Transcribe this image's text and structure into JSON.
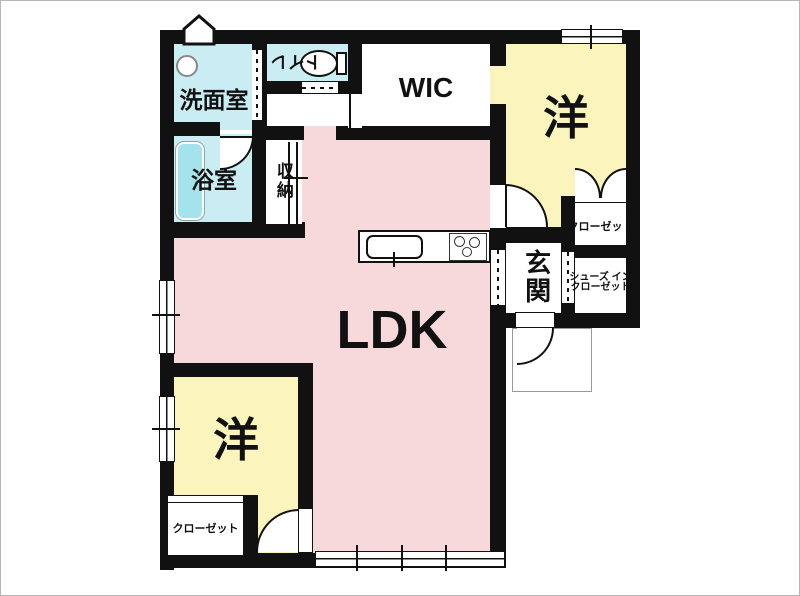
{
  "colors": {
    "wall": "#111111",
    "water_room": "#c9edf3",
    "bedroom": "#fbf5bd",
    "ldk": "#f8d9db",
    "bathtub": "#a5e3ec"
  },
  "rooms": {
    "washroom": {
      "label": "洗面室"
    },
    "toilet": {
      "label": "トイレ"
    },
    "bathroom": {
      "label": "浴室"
    },
    "storage": {
      "label": "収納"
    },
    "wic": {
      "label": "WIC"
    },
    "bedroom_top": {
      "label": "洋"
    },
    "closet_top": {
      "label": "クローゼット"
    },
    "entrance": {
      "label": "玄関"
    },
    "shoes_closet": {
      "line1": "シューズ イン",
      "line2": "クローゼット"
    },
    "ldk": {
      "label": "LDK"
    },
    "bedroom_bottom": {
      "label": "洋"
    },
    "closet_bottom": {
      "label": "クローゼット"
    }
  }
}
